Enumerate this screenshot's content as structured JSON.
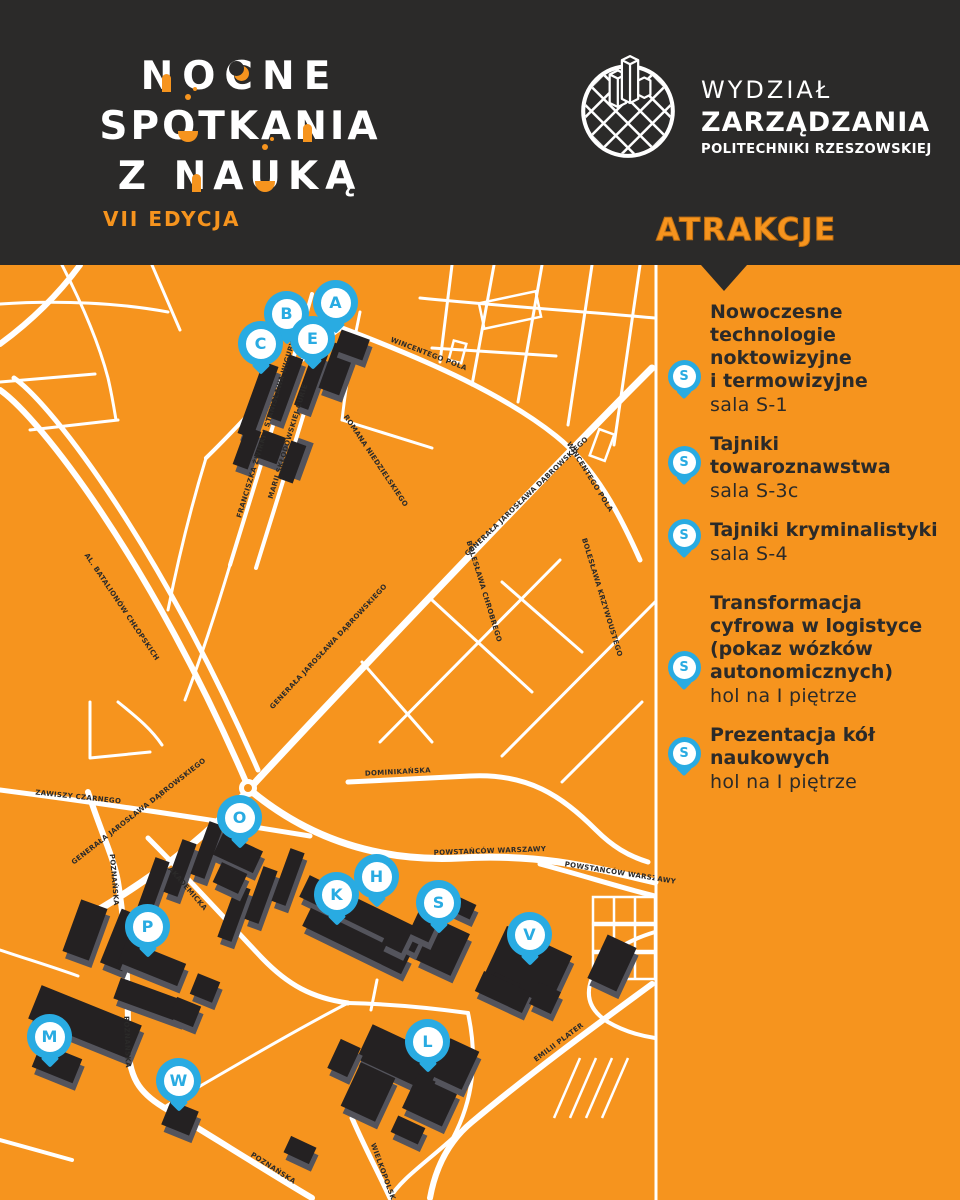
{
  "colors": {
    "orange": "#F6941E",
    "dark": "#2B2A29",
    "pin_blue": "#29ABE2",
    "white": "#FFFFFF"
  },
  "header": {
    "event_logo": {
      "line1": "NOCNE",
      "line2": "SPOTKANIA",
      "line3": "Z NAUKĄ",
      "edition": "VII EDYCJA"
    },
    "faculty_logo": {
      "line1": "WYDZIAŁ",
      "line2": "ZARZĄDZANIA",
      "line3": "POLITECHNIKI RZESZOWSKIEJ"
    }
  },
  "sidebar": {
    "title": "ATRAKCJE",
    "attractions": [
      {
        "pin": "S",
        "title": "Nowoczesne\ntechnologie\nnoktowizyjne\ni termowizyjne",
        "room": "sala S-1"
      },
      {
        "pin": "S",
        "title": "Tajniki\ntowaroznawstwa",
        "room": "sala S-3c"
      },
      {
        "pin": "S",
        "title": "Tajniki kryminalistyki",
        "room": "sala S-4"
      },
      {
        "pin": "S",
        "title": "Transformacja\ncyfrowa w logistyce\n(pokaz wózków\nautonomicznych)",
        "room": "hol na I piętrze"
      },
      {
        "pin": "S",
        "title": "Prezentacja kół\nnaukowych",
        "room": "hol na I piętrze"
      }
    ]
  },
  "map": {
    "pins": [
      {
        "letter": "A",
        "x": 336,
        "y": 303
      },
      {
        "letter": "B",
        "x": 287,
        "y": 314
      },
      {
        "letter": "C",
        "x": 261,
        "y": 344
      },
      {
        "letter": "E",
        "x": 313,
        "y": 339
      },
      {
        "letter": "O",
        "x": 240,
        "y": 818
      },
      {
        "letter": "H",
        "x": 377,
        "y": 877
      },
      {
        "letter": "K",
        "x": 337,
        "y": 895
      },
      {
        "letter": "S",
        "x": 439,
        "y": 903
      },
      {
        "letter": "V",
        "x": 530,
        "y": 935
      },
      {
        "letter": "P",
        "x": 148,
        "y": 927
      },
      {
        "letter": "M",
        "x": 50,
        "y": 1037
      },
      {
        "letter": "W",
        "x": 179,
        "y": 1081
      },
      {
        "letter": "L",
        "x": 428,
        "y": 1042
      }
    ],
    "street_labels": [
      {
        "name": "FRANCISZKA ŻWIRKI I STANISŁAWA WIGURY",
        "x": 268,
        "y": 430,
        "rot": -73
      },
      {
        "name": "MARII SKŁODOWSKIEJ-CURIE",
        "x": 290,
        "y": 442,
        "rot": -73
      },
      {
        "name": "ROMANA NIEDZIELSKIEGO",
        "x": 374,
        "y": 462,
        "rot": 56
      },
      {
        "name": "WINCENTEGO POLA",
        "x": 428,
        "y": 356,
        "rot": 21
      },
      {
        "name": "WINCENTEGO POLA",
        "x": 588,
        "y": 478,
        "rot": 58
      },
      {
        "name": "GENERAŁA JAROSŁAWA DĄBROWSKIEGO",
        "x": 528,
        "y": 498,
        "rot": -44
      },
      {
        "name": "GENERAŁA JAROSŁAWA DĄBROWSKIEGO",
        "x": 330,
        "y": 648,
        "rot": -47
      },
      {
        "name": "GENERAŁA JAROSŁAWA DĄBROWSKIEGO",
        "x": 140,
        "y": 813,
        "rot": -38
      },
      {
        "name": "AL. BATALIONÓW CHŁOPSKICH",
        "x": 120,
        "y": 608,
        "rot": 56
      },
      {
        "name": "ZAWISZY CZARNEGO",
        "x": 78,
        "y": 799,
        "rot": 6
      },
      {
        "name": "DOMINIKAŃSKA",
        "x": 398,
        "y": 774,
        "rot": -3
      },
      {
        "name": "POWSTAŃCÓW WARSZAWY",
        "x": 490,
        "y": 853,
        "rot": -2
      },
      {
        "name": "POWSTAŃCÓW WARSZAWY",
        "x": 620,
        "y": 875,
        "rot": 9
      },
      {
        "name": "POZNAŃSKA",
        "x": 112,
        "y": 880,
        "rot": 85
      },
      {
        "name": "POZNAŃSKA",
        "x": 125,
        "y": 1042,
        "rot": 88
      },
      {
        "name": "POZNAŃSKA",
        "x": 272,
        "y": 1170,
        "rot": 33
      },
      {
        "name": "AKADEMICKA",
        "x": 186,
        "y": 890,
        "rot": 49
      },
      {
        "name": "EMILII PLATER",
        "x": 560,
        "y": 1044,
        "rot": -37
      },
      {
        "name": "WIELKOPOLSKA",
        "x": 382,
        "y": 1175,
        "rot": 70
      },
      {
        "name": "BOLESŁAWA CHROBREGO",
        "x": 482,
        "y": 592,
        "rot": 73
      },
      {
        "name": "BOLESŁAWA KRZYWOUSTEGO",
        "x": 600,
        "y": 598,
        "rot": 73
      }
    ]
  }
}
